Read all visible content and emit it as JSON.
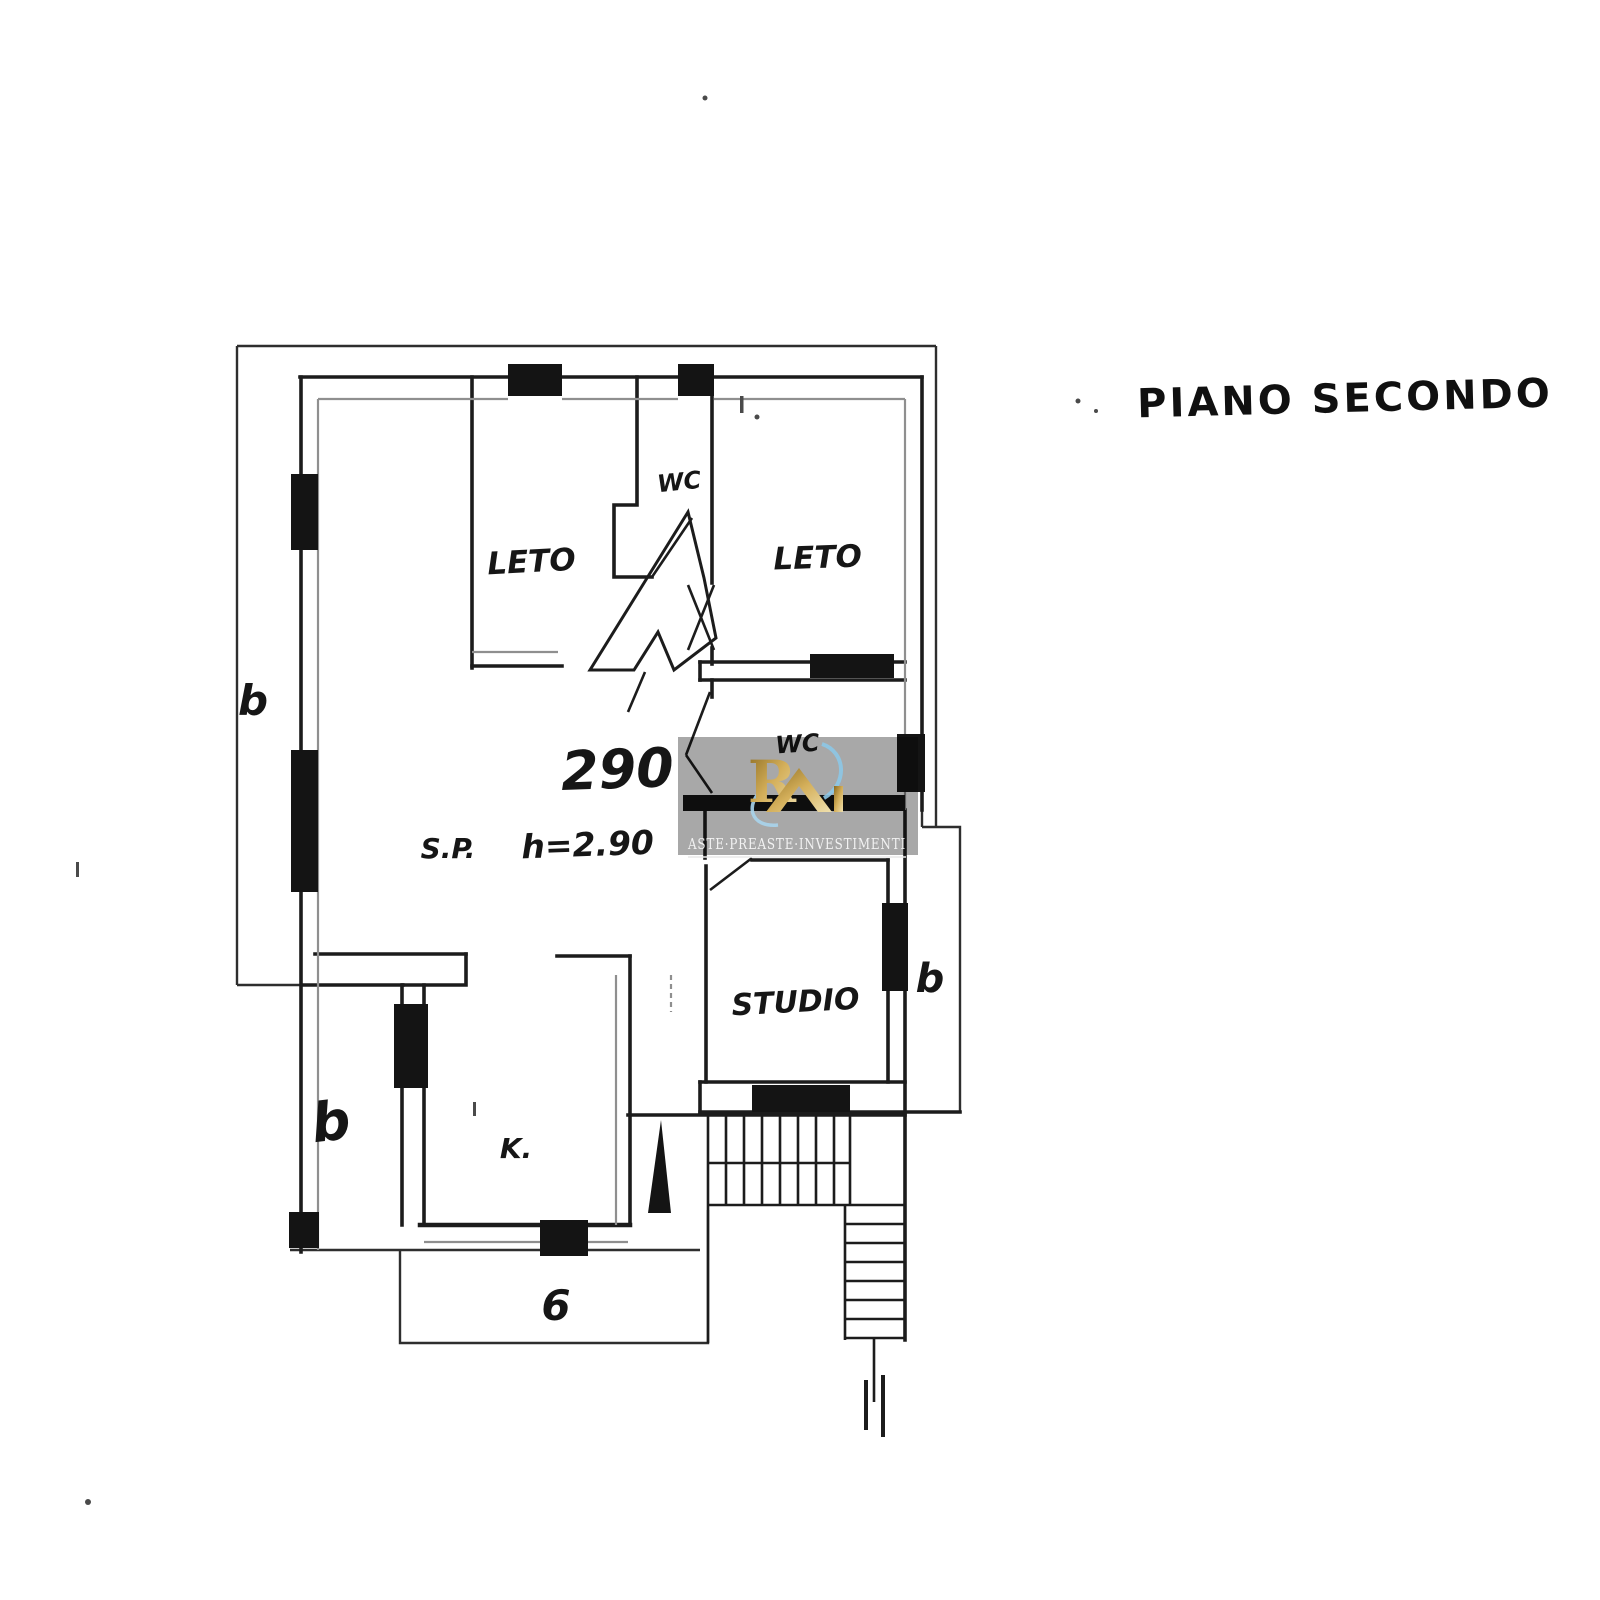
{
  "page": {
    "background_color": "#ffffff",
    "ink_color": "#1c1c1c",
    "secondary_line_color": "#8f8f8f"
  },
  "title": {
    "text": "PIANO SECONDO"
  },
  "plan": {
    "rooms": [
      {
        "id": "letto-left",
        "label": "LETO"
      },
      {
        "id": "wc-top",
        "label": "WC"
      },
      {
        "id": "letto-right",
        "label": "LETO"
      },
      {
        "id": "wc-middle",
        "label": "WC"
      },
      {
        "id": "studio",
        "label": "STUDIO"
      },
      {
        "id": "kitchen",
        "label": "K."
      }
    ],
    "annotations": {
      "area_number": "290",
      "sp_label": "S.P.",
      "height_label": "h=2.90",
      "balcony_left": "b",
      "balcony_lower_left": "b",
      "balcony_bottom": "6",
      "balcony_right": "b"
    }
  },
  "watermark": {
    "text": "ASTE·PREASTE·INVESTIMENTI",
    "panel_color": "#a8a8a8",
    "gold_color": "#c9a23c",
    "gold_light_color": "#efe0ae",
    "blue_color": "#8cc6e6",
    "text_color": "#f2f2f2",
    "logo_monogram": "R"
  }
}
